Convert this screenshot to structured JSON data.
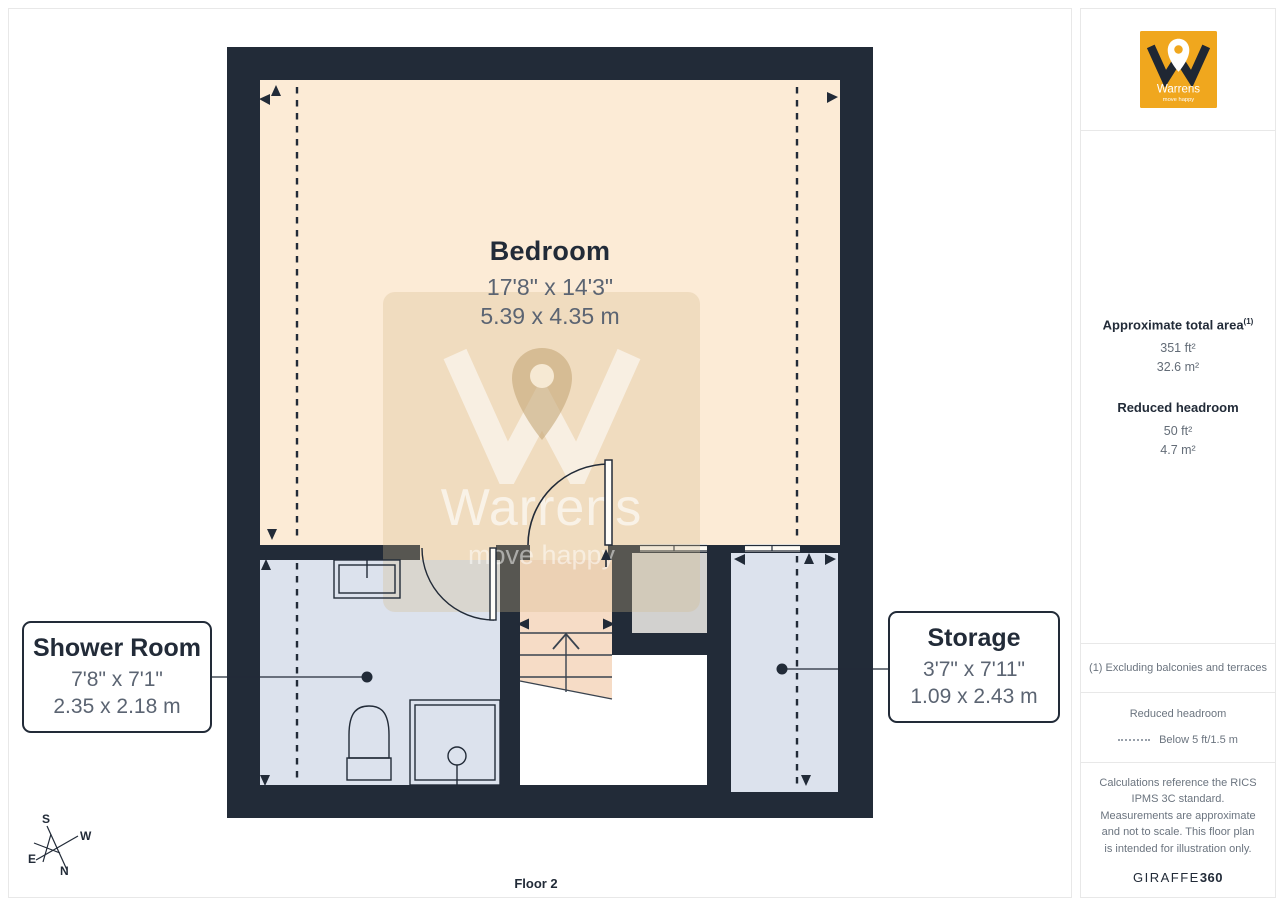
{
  "page": {
    "floor_label": "Floor 2"
  },
  "rooms": {
    "bedroom": {
      "name": "Bedroom",
      "dims_imperial": "17'8\" x 14'3\"",
      "dims_metric": "5.39 x 4.35 m"
    },
    "shower": {
      "name": "Shower Room",
      "dims_imperial": "7'8\" x 7'1\"",
      "dims_metric": "2.35 x 2.18 m"
    },
    "storage": {
      "name": "Storage",
      "dims_imperial": "3'7\" x 7'11\"",
      "dims_metric": "1.09 x 2.43 m"
    }
  },
  "compass": {
    "n": "N",
    "s": "S",
    "e": "E",
    "w": "W"
  },
  "watermark": {
    "brand": "Warrens",
    "tagline": "move happy"
  },
  "logo": {
    "brand": "Warrens",
    "tagline": "move happy"
  },
  "sidebar": {
    "area": {
      "title": "Approximate total area",
      "sup": "(1)",
      "ft": "351 ft²",
      "m": "32.6 m²"
    },
    "headroom": {
      "title": "Reduced headroom",
      "ft": "50 ft²",
      "m": "4.7 m²"
    },
    "note": "(1) Excluding balconies and terraces",
    "legend": {
      "title": "Reduced headroom",
      "label": "Below 5 ft/1.5 m"
    },
    "disclaimer": "Calculations reference the RICS IPMS 3C standard. Measurements are approximate and not to scale. This floor plan is intended for illustration only.",
    "brand_footer": {
      "name": "GIRAFFE",
      "suffix": "360"
    }
  },
  "colors": {
    "wall": "#222b38",
    "bedroom_floor": "#fcebd6",
    "wet_room_floor": "#dce2ed",
    "stairs_floor": "#f6dcc6",
    "void_grey": "#d2d1cf",
    "brand_orange": "#f0a71e",
    "dim_text": "#5b6472"
  }
}
